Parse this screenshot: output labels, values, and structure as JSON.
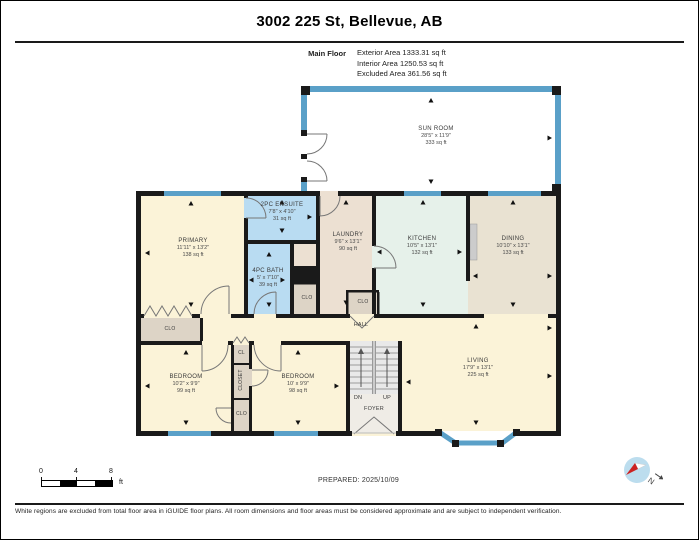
{
  "page": {
    "title": "3002 225 St, Bellevue, AB",
    "prepared": "PREPARED: 2025/10/09",
    "disclaimer": "White regions are excluded from total floor area in iGUIDE floor plans. All room dimensions and floor areas must be considered approximate and are subject to independent verification."
  },
  "floor_summary": {
    "label": "Main Floor",
    "exterior": "Exterior Area 1333.31 sq ft",
    "interior": "Interior Area 1250.53 sq ft",
    "excluded": "Excluded Area 361.56 sq ft"
  },
  "rooms": {
    "sunroom": {
      "name": "SUN ROOM",
      "dims": "28'5\" x 11'9\"",
      "area": "333 sq ft"
    },
    "primary": {
      "name": "PRIMARY",
      "dims": "11'11\" x 13'2\"",
      "area": "138 sq ft"
    },
    "ensuite": {
      "name": "2PC ENSUITE",
      "dims": "7'8\" x 4'10\"",
      "area": "31 sq ft"
    },
    "bath": {
      "name": "4PC BATH",
      "dims": "5' x 7'10\"",
      "area": "39 sq ft"
    },
    "laundry": {
      "name": "LAUNDRY",
      "dims": "9'6\" x 13'1\"",
      "area": "90 sq ft"
    },
    "kitchen": {
      "name": "KITCHEN",
      "dims": "10'5\" x 13'1\"",
      "area": "132 sq ft"
    },
    "dining": {
      "name": "DINING",
      "dims": "10'10\" x 13'1\"",
      "area": "133 sq ft"
    },
    "living": {
      "name": "LIVING",
      "dims": "17'9\" x 13'1\"",
      "area": "225 sq ft"
    },
    "bedroom_left": {
      "name": "BEDROOM",
      "dims": "10'2\" x 9'9\"",
      "area": "99 sq ft"
    },
    "bedroom_right": {
      "name": "BEDROOM",
      "dims": "10' x 9'9\"",
      "area": "98 sq ft"
    },
    "hall": {
      "name": "HALL"
    },
    "foyer": {
      "name": "FOYER"
    }
  },
  "closets": {
    "cl": "CL",
    "closet": "CLOSET",
    "clo": "CLO"
  },
  "stairs": {
    "down": "DN",
    "up": "UP"
  },
  "scale": {
    "t0": "0",
    "t4": "4",
    "t8": "8",
    "unit": "ft"
  },
  "compass": {
    "north_label": "N"
  },
  "colors": {
    "wall": "#1a1a1a",
    "window_blue": "#5aa0c8",
    "room_beige": "#fbf3d8",
    "bath_blue": "#b9dcf2",
    "kitchen_mint": "#e6f1ea",
    "dining_taupe": "#e9e2d2",
    "laundry_tan": "#ece0d2",
    "closet_gray": "#ddd4c6",
    "stairs_gray": "#e9e9e9"
  }
}
